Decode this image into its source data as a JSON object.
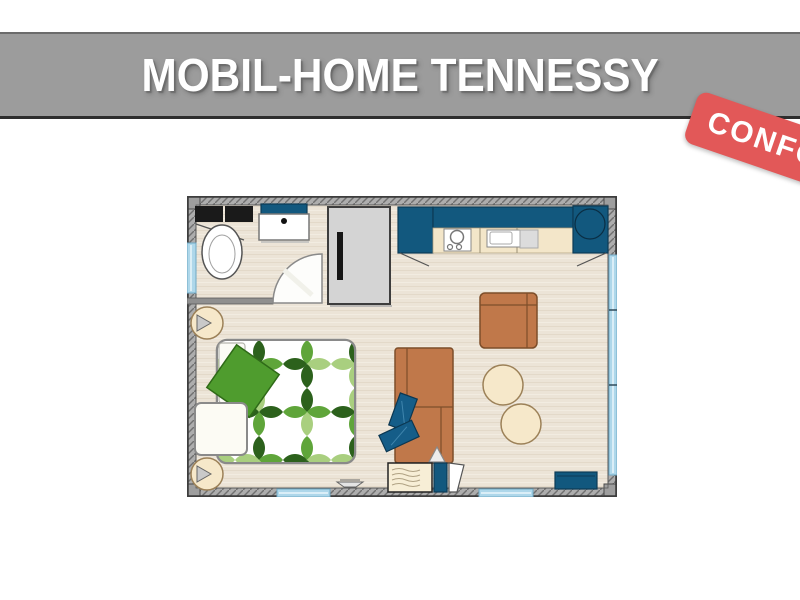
{
  "header": {
    "title": "MOBIL-HOME TENNESSY"
  },
  "badge": {
    "label": "CONFORT"
  },
  "floorplan": {
    "elements": [
      "bathroom-counter",
      "toilet",
      "washbasin",
      "bathroom-door",
      "wardrobe",
      "kitchen-tall-cabinet",
      "kitchen-upper-cabinets",
      "kitchen-counter",
      "stove",
      "kitchen-sink",
      "corner-unit",
      "double-bed",
      "bed-pillow",
      "bed-throw",
      "bedside-table",
      "wall-lamp",
      "armchair",
      "sofa",
      "sofa-cushions",
      "entry-console",
      "entry-door",
      "pouf",
      "pouf",
      "tv-bench",
      "windows"
    ]
  },
  "colors": {
    "header_gray": "#9c9c9c",
    "header_border_dark": "#2e2e2e",
    "badge_red": "#e25858",
    "wall_gray": "#adadad",
    "wall_line": "#707070",
    "floor_cream": "#ece4d7",
    "cabinet_blue": "#12587e",
    "window_blue": "#aed7ea",
    "counter_cream": "#f3e6c9",
    "sofa_brown": "#c0784a",
    "sofa_line": "#7d4e2a",
    "pouf_cream": "#f6e8ca",
    "leaf_dark": "#2c611c",
    "leaf_mid": "#5fa53a",
    "leaf_light": "#a9cf7f",
    "wardrobe_gray": "#d4d4d4",
    "pillow_blue": "#155d88"
  }
}
